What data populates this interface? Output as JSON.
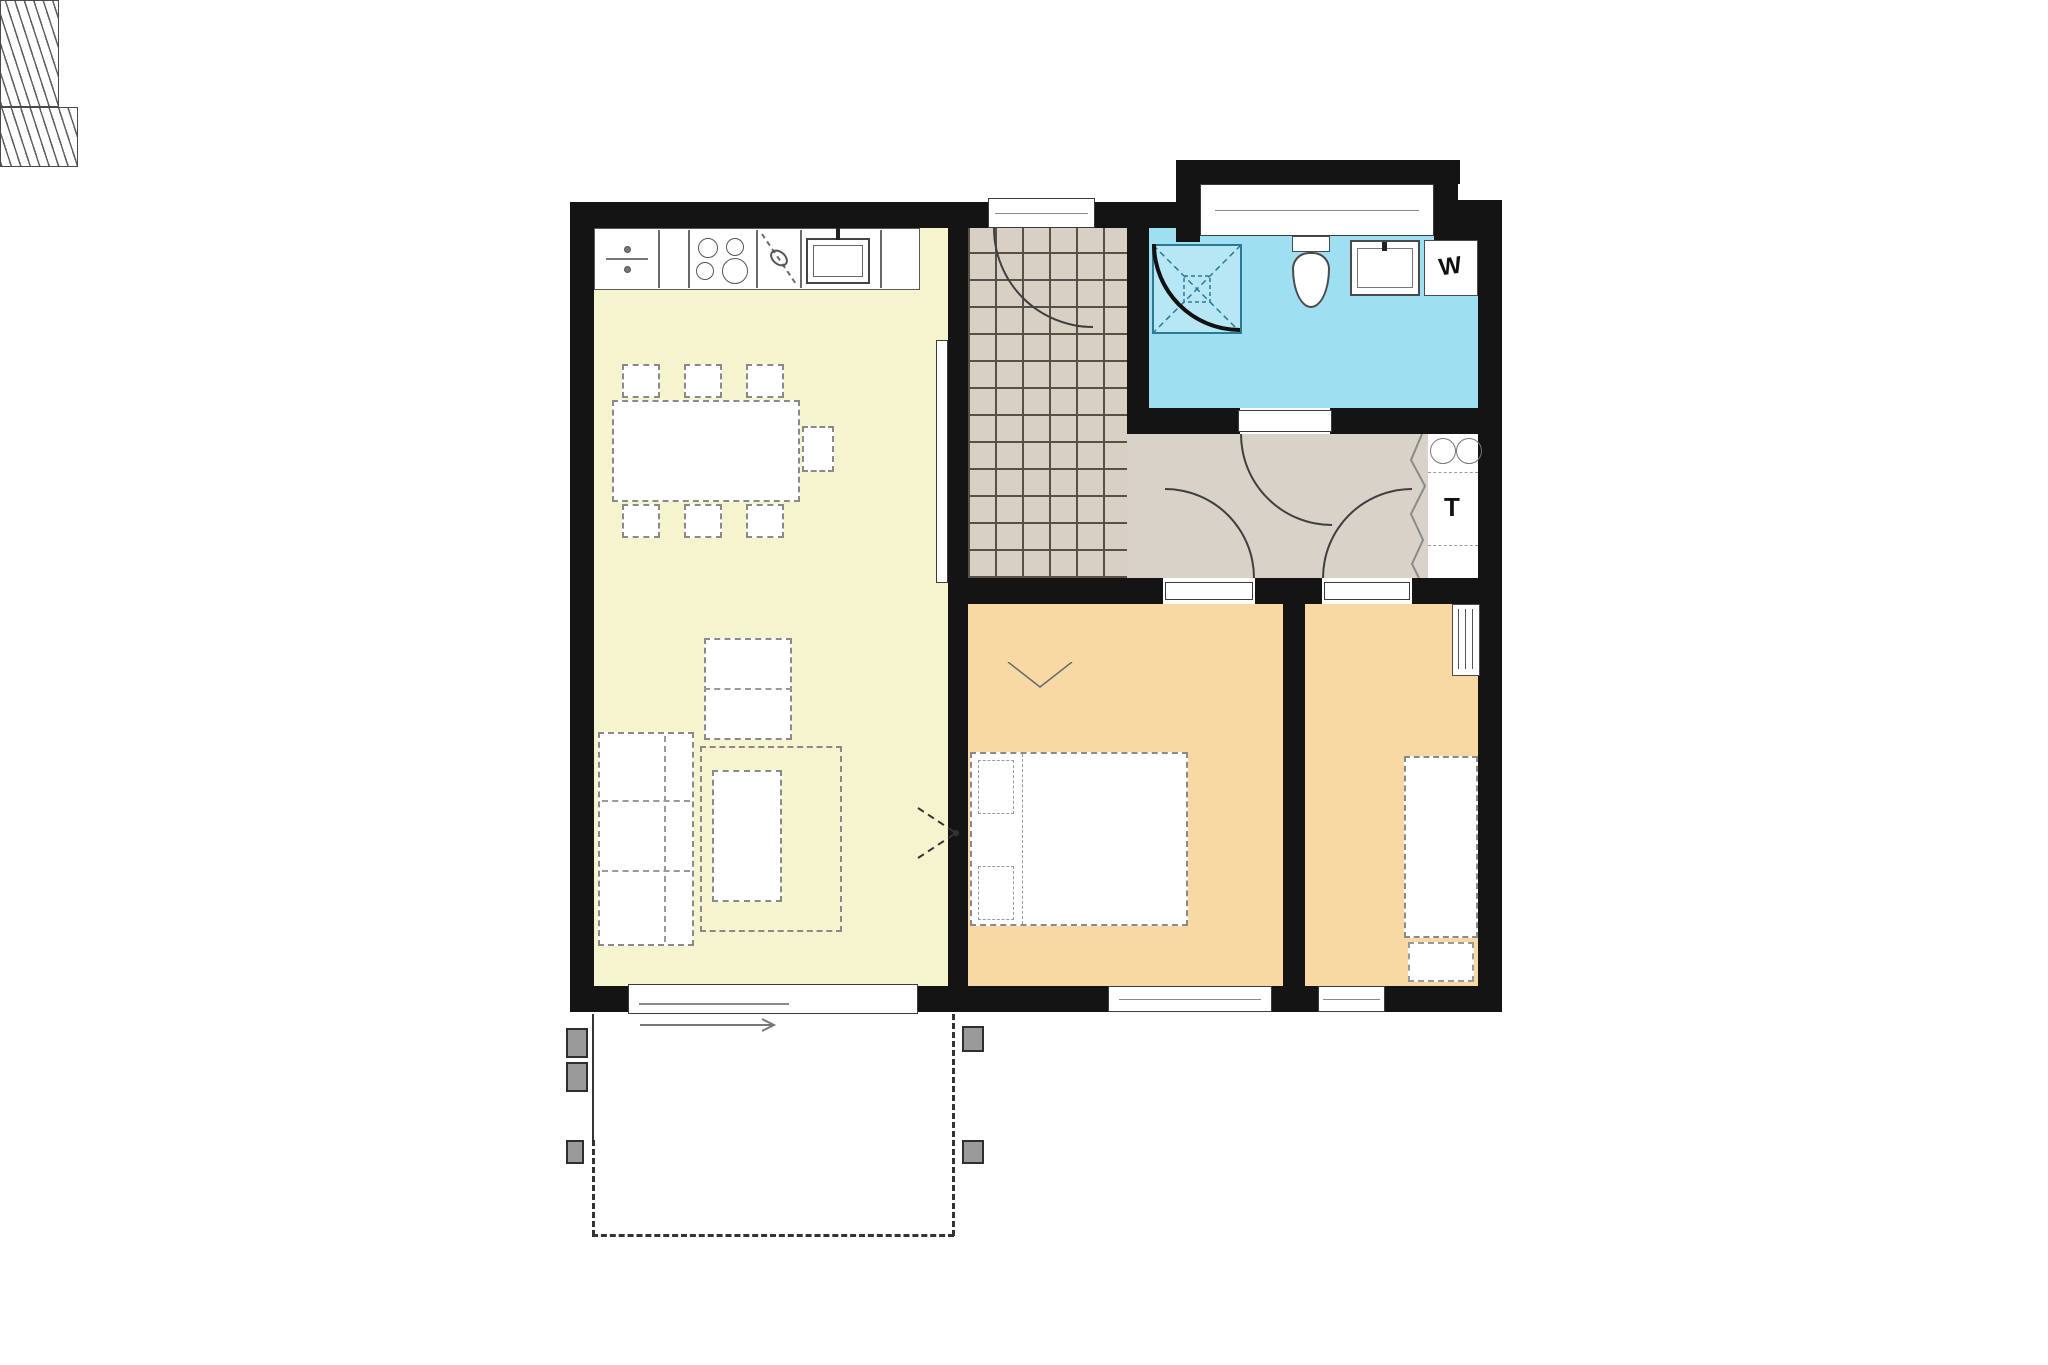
{
  "colors": {
    "page": "#ffffff",
    "wall": "#141414",
    "living": "#f6f3cf",
    "bedroom": "#f8d9a3",
    "bathroom": "#9fdff2",
    "hallway": "#d9d2c9",
    "tile": "#d9d0c4",
    "grout": "#55504a",
    "shower_line": "#2b7a94",
    "dash": "#8a8a8a"
  },
  "labels": {
    "technical_room": "T",
    "washing_machine": "W"
  },
  "rooms": [
    {
      "id": "living-kitchen",
      "fill": "living"
    },
    {
      "id": "entry-hall-tiled",
      "fill": "tile"
    },
    {
      "id": "bathroom",
      "fill": "bathroom"
    },
    {
      "id": "hallway",
      "fill": "hallway"
    },
    {
      "id": "technical-room",
      "fill": "page"
    },
    {
      "id": "bedroom-1",
      "fill": "bedroom"
    },
    {
      "id": "bedroom-2",
      "fill": "bedroom"
    },
    {
      "id": "terrace",
      "fill": "page"
    }
  ],
  "fixtures": [
    "kitchen-counter",
    "dishwasher",
    "cooktop",
    "kitchen-sink",
    "dining-table",
    "dining-chairs",
    "side-table",
    "sofa",
    "coffee-table",
    "rug",
    "sliding-terrace-door",
    "pocket-door",
    "entrance-door",
    "wardrobe-entry",
    "shower",
    "toilet",
    "bathroom-sink",
    "washing-machine",
    "bay-window",
    "bathroom-door",
    "bifold-door",
    "utility-circles",
    "radiator",
    "wardrobe-bedroom-1",
    "double-bed",
    "single-bed",
    "nightstand",
    "terrace-posts",
    "windows"
  ]
}
